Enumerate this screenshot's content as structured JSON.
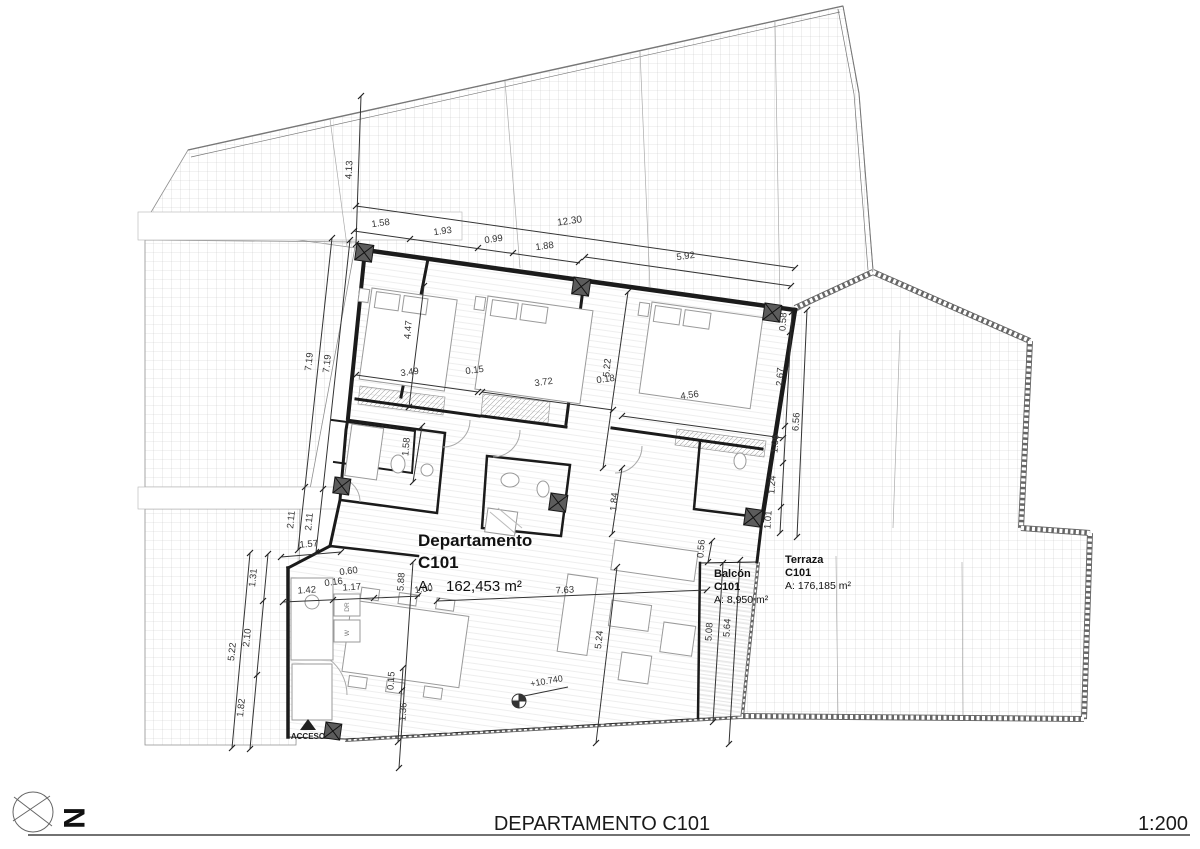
{
  "labels": {
    "dept_title": "Departamento",
    "dept_code": "C101",
    "dept_area_label": "A:",
    "dept_area_value": "162,453 m²",
    "balcon_title": "Balcón",
    "balcon_code": "C101",
    "balcon_area": "A: 8,950 m²",
    "terraza_title": "Terraza",
    "terraza_code": "C101",
    "terraza_area": "A: 176,185 m²",
    "acceso": "ACCESO",
    "level": "+10.740",
    "washer": "W",
    "dryer": "DR",
    "north": "N"
  },
  "footer": {
    "title": "DEPARTAMENTO C101",
    "scale": "1:200"
  },
  "dims": {
    "t158": "1.58",
    "t193": "1.93",
    "t099": "0.99",
    "t188": "1.88",
    "t1230": "12.30",
    "t592": "5.92",
    "l413": "4.13",
    "l719a": "7.19",
    "l719b": "7.19",
    "l211a": "2.11",
    "l211b": "2.11",
    "l157": "1.57",
    "l131": "1.31",
    "l210": "2.10",
    "l522": "5.22",
    "l182": "1.82",
    "i060": "0.60",
    "i016": "0.16",
    "i142": "1.42",
    "i117": "1.17",
    "i100": "1.00",
    "i588": "5.88",
    "i015": "0.15",
    "i136": "1.36",
    "b447": "4.47",
    "b349": "3.49",
    "b015": "0.15",
    "b372": "3.72",
    "b018": "0.18",
    "b522": "5.22",
    "b456": "4.56",
    "b158": "1.58",
    "b184": "1.84",
    "b056": "0.56",
    "r058": "0.58",
    "r267": "2.67",
    "r106": "1.06",
    "r124": "1.24",
    "r101": "1.01",
    "r656": "6.56",
    "m763": "7.63",
    "m524": "5.24",
    "m508": "5.08",
    "m564": "5.64"
  }
}
